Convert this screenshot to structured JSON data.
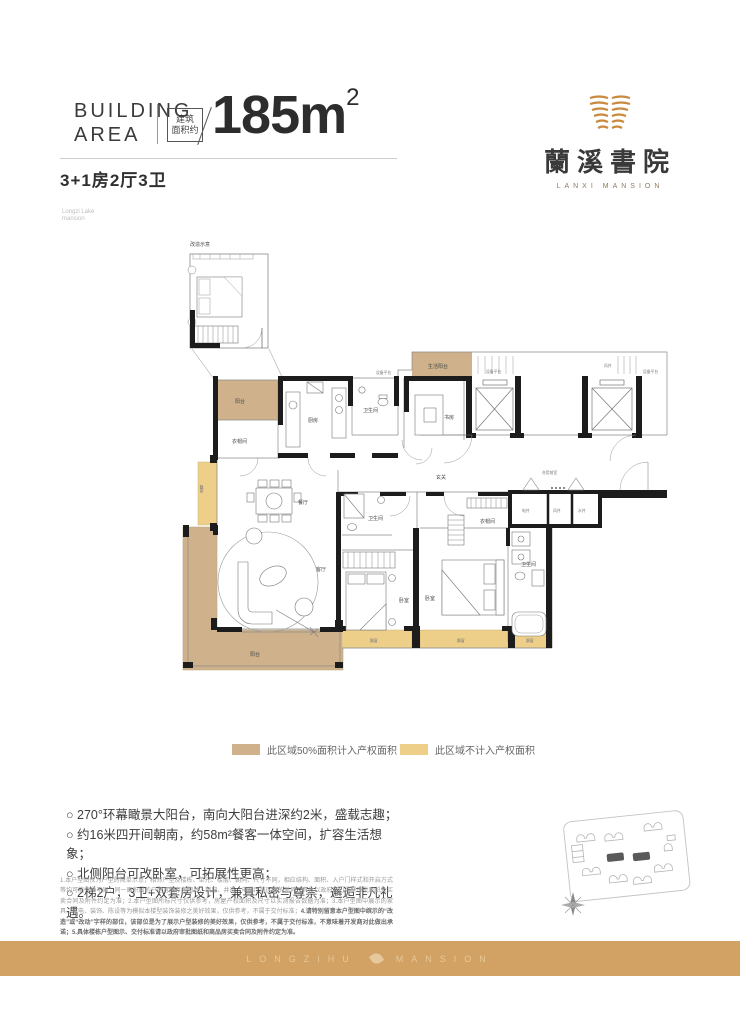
{
  "header": {
    "building_word": "BUILDING",
    "area_word": "AREA",
    "badge_line1": "建筑",
    "badge_line2": "面积约",
    "area_value": "185m",
    "area_superscript": "2",
    "unit_type": "3+1房2厅3卫"
  },
  "logo": {
    "cn": "蘭溪書院",
    "en": "LANXI MANSION"
  },
  "plan": {
    "inset_title": "改造示意",
    "corner_note_1": "Longzi Lake",
    "corner_note_2": "mansion",
    "labels": {
      "north_balcony": "阳台",
      "cloakroom": "衣帽间",
      "kitchen": "厨房",
      "bathroom": "卫生间",
      "life_balcony": "生活阳台",
      "equipment_platform": "设备平台",
      "study": "书房",
      "wind_shaft": "风井",
      "foyer": "玄关",
      "shared_lobby": "合用前室",
      "electric_shaft": "电井",
      "water_shaft": "水井",
      "dining": "餐厅",
      "living": "客厅",
      "bedroom": "卧室",
      "bay_window": "飘窗",
      "south_balcony": "阳台"
    }
  },
  "legend": {
    "items": [
      {
        "label": "此区域50%面积计入产权面积",
        "color": "#CFB28B"
      },
      {
        "label": "此区域不计入产权面积",
        "color": "#EECF8A"
      }
    ]
  },
  "features": [
    "○ 270°环幕瞰景大阳台，南向大阳台进深约2米，盛载志趣；",
    "○ 约16米四开间朝南，约58m²餐客一体空间，扩容生活想象；",
    "○ 北侧阳台可改卧室，可拓展性更高；",
    "○ 2梯2户，3卫+双套房设计，兼具私密与尊崇，邂逅非凡礼遇。"
  ],
  "disclaimer": {
    "normal": "1.本户型图仅为户型的简单示意，相邻户型及楼栋、单元、楼层、朝向、尺寸不同，相应结构、面积、入户门样式和开启方式等均可能有所不同；同一面积段的户型可能存在阳台、飘窗、井道、电梯厅等区域的差异，具体以政府部门最终审批图纸及买卖合同及附件约定为准；2.本户型图所标尺寸仅供参考，房屋产权面积及尺寸以实测报告数据为准；3.本户型图中展示的家具、家电、装饰、陈设等为模拟本楼型装饰装修之美好效果，仅供参考，不属于交付标准；",
    "bold": "4.请特别留意本户型图中缤示的“改造”或“改动”字样的部位，该部位是为了展示户型装修的美好效果，仅供参考，不属于交付标准，不意味着开发商对此做出承诺；5.具体楼栋户型图示、交付标准请以政府审批图纸和商品房买卖合同及附件约定为准。"
  },
  "footer": {
    "brand_left": "LONGZIHU",
    "brand_right": "MANSION"
  }
}
